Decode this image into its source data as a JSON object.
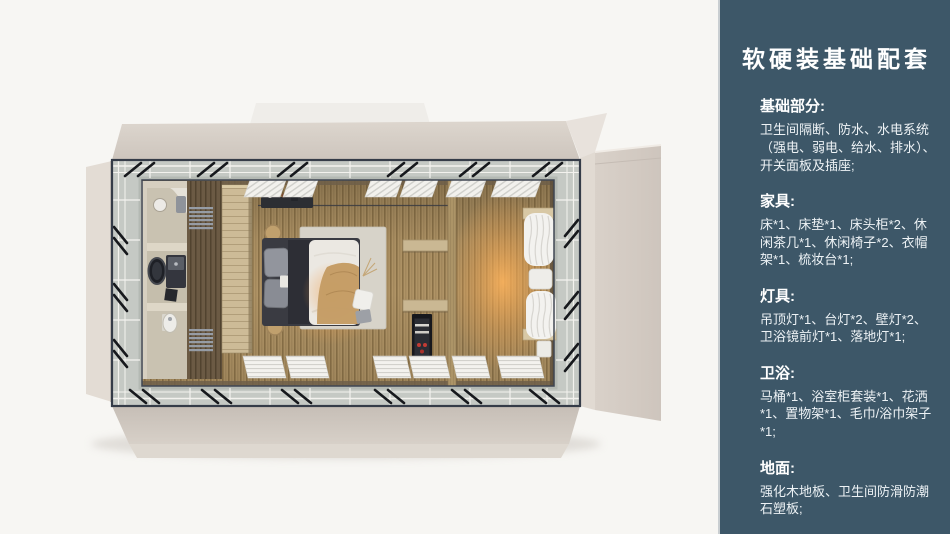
{
  "panel": {
    "title": "软硬装基础配套",
    "sections": [
      {
        "id": "basics",
        "heading": "基础部分:",
        "body": "卫生间隔断、防水、水电系统（强电、弱电、给水、排水）、开关面板及插座;"
      },
      {
        "id": "furniture",
        "heading": "家具:",
        "body": "床*1、床垫*1、床头柜*2、休闲茶几*1、休闲椅子*2、衣帽架*1、梳妆台*1;"
      },
      {
        "id": "lighting",
        "heading": "灯具:",
        "body": "吊顶灯*1、台灯*2、壁灯*2、卫浴镜前灯*1、落地灯*1;"
      },
      {
        "id": "bathroom",
        "heading": "卫浴:",
        "body": "马桶*1、浴室柜套装*1、花洒*1、置物架*1、毛巾/浴巾架子*1;"
      },
      {
        "id": "floor",
        "heading": "地面:",
        "body": "强化木地板、卫生间防滑防潮石塑板;"
      }
    ],
    "colors": {
      "background": "#3d5768",
      "heading": "#ffffff",
      "body": "#edf2f5"
    }
  },
  "render": {
    "subject": "top-down-room-module-floorplan",
    "colors": {
      "page_background": "#f7f6f3",
      "shell_beige": "#d6cec6",
      "walkway_gray": "#c5c9c4",
      "wood_floor": "#b09466",
      "warm_glow": "#f0a050",
      "frame_dark": "#353c48"
    }
  }
}
